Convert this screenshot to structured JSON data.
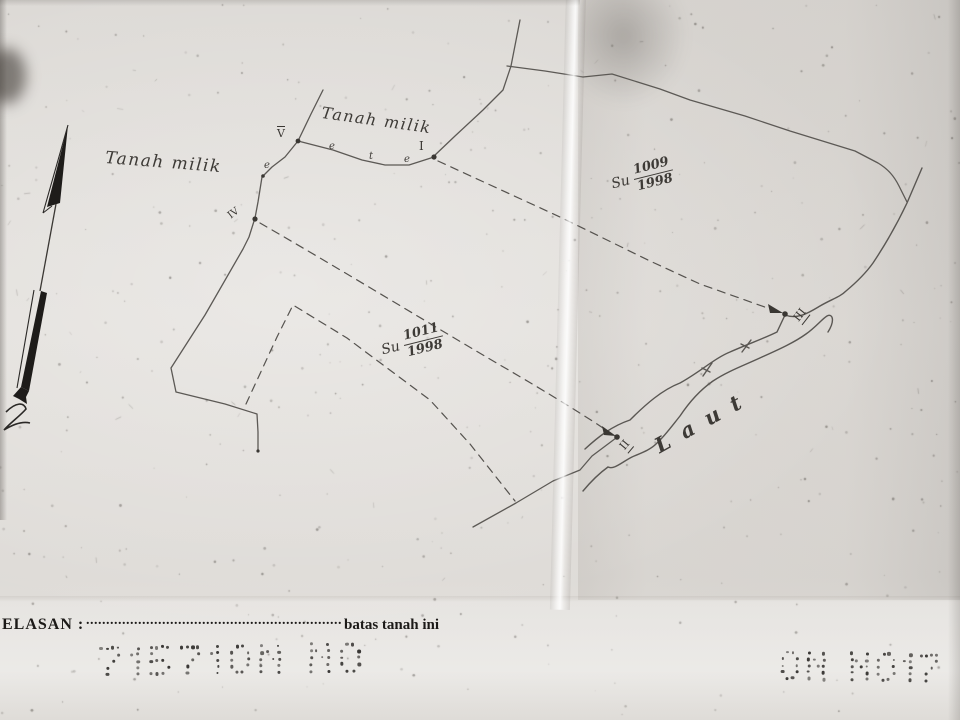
{
  "map": {
    "area_labels": {
      "tanah_milik_left": "Tanah milik",
      "tanah_milik_top": "Tanah milik",
      "sea": "Laut"
    },
    "parcels": [
      {
        "prefix": "Su",
        "number": "1009",
        "year": "1998"
      },
      {
        "prefix": "Su",
        "number": "1011",
        "year": "1998"
      }
    ],
    "points": [
      {
        "label": "I"
      },
      {
        "label": "II"
      },
      {
        "label": "III"
      },
      {
        "label": "IV"
      },
      {
        "label": "V"
      }
    ],
    "fence_marks": [
      {
        "char": "e"
      },
      {
        "char": "t"
      },
      {
        "char": "e"
      },
      {
        "char": "e"
      }
    ],
    "north_arrow_icon": "north-arrow"
  },
  "footer": {
    "label": "ELASAN :",
    "dotted_line": "..........................................................................................................",
    "suffix": "batas tanah ini"
  },
  "stamps": {
    "left": "715710N NO",
    "right": "ON NO17"
  },
  "colors": {
    "paper": "#dfdcd8",
    "ink": "#55524e",
    "handwriting": "#3d3a36"
  }
}
